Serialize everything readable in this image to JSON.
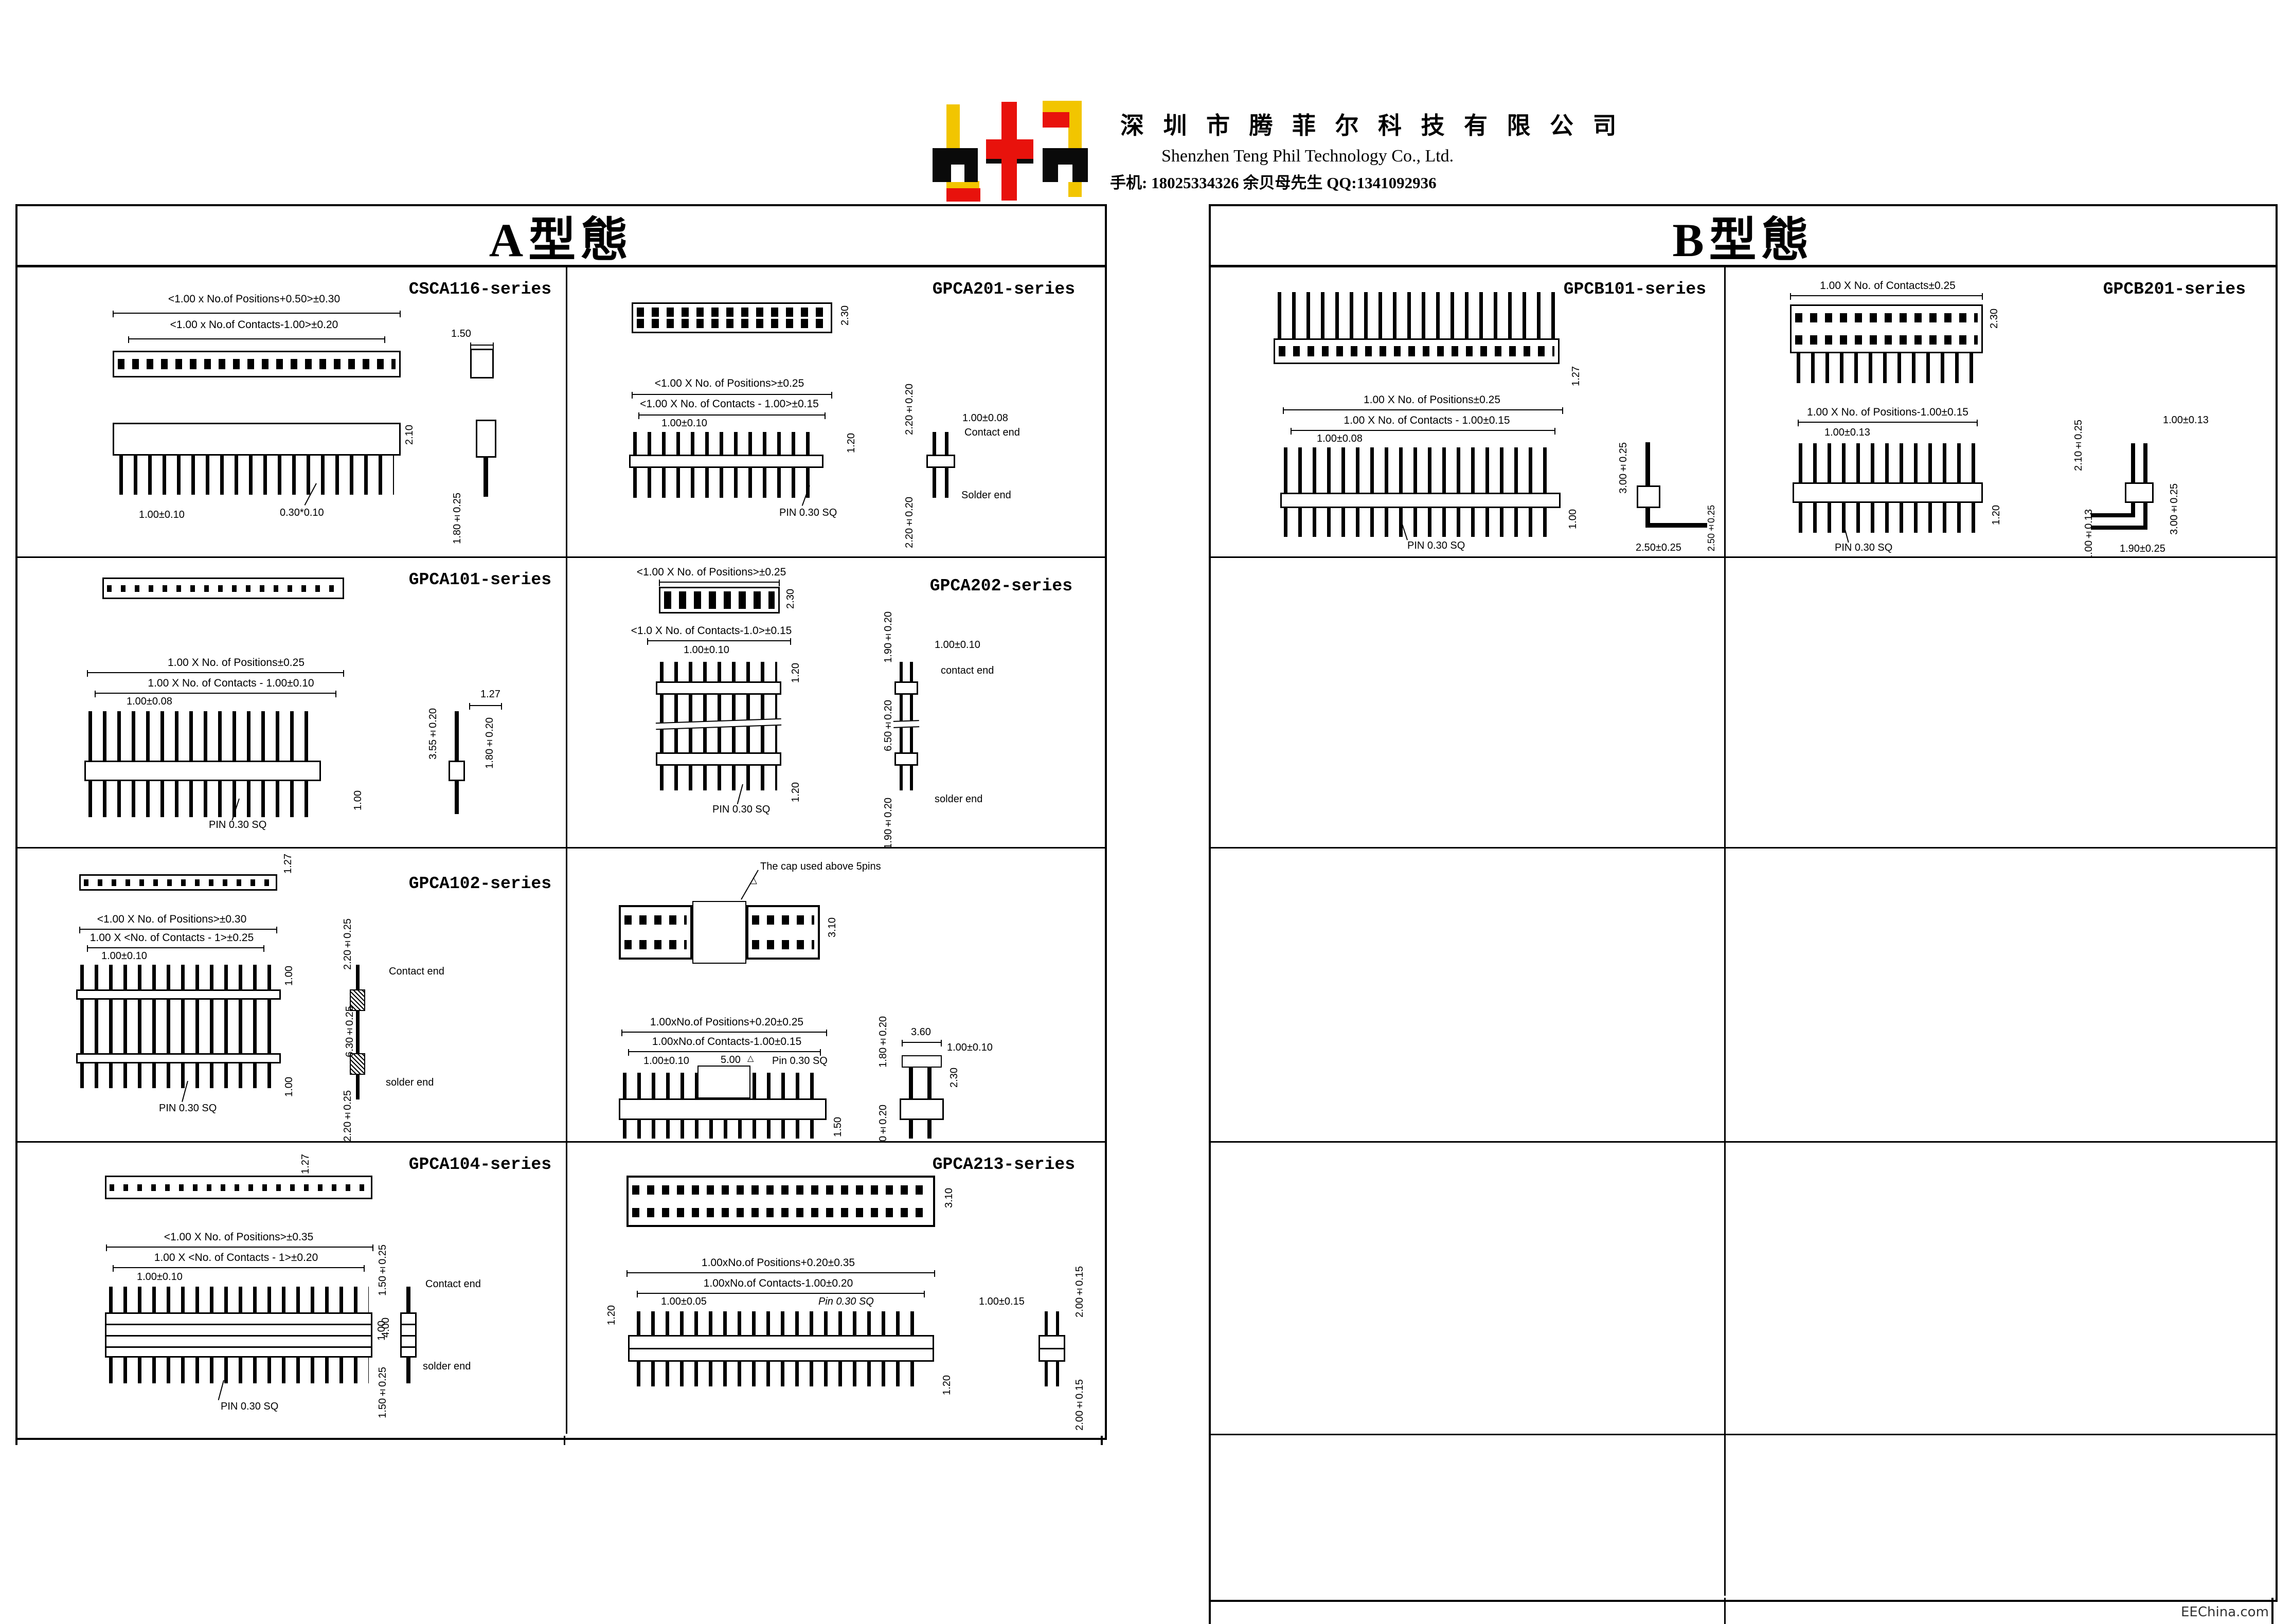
{
  "header": {
    "company_cn": "深 圳 市 腾 菲 尔 科 技 有 限 公 司",
    "company_en": "Shenzhen Teng Phil Technology Co., Ltd.",
    "contact": "手机: 18025334326 余贝母先生    QQ:1341092936"
  },
  "sections": {
    "a_title": "A型態",
    "b_title": "B型態"
  },
  "watermark": "EEChina.com",
  "cells": {
    "csca116": {
      "title": "CSCA116-series",
      "dim_positions": "<1.00 x No.of Positions+0.50>±0.30",
      "dim_contacts": "<1.00 x No.of Contacts-1.00>±0.20",
      "dim_150": "1.50",
      "dim_210": "2.10",
      "dim_pitch": "1.00±0.10",
      "dim_pin": "0.30*0.10",
      "dim_180": "1.80±0.25"
    },
    "gpca201": {
      "title": "GPCA201-series",
      "dim_230": "2.30",
      "dim_positions": "<1.00 X No. of Positions>±0.25",
      "dim_contacts": "<1.00 X No. of Contacts - 1.00>±0.15",
      "dim_pitch": "1.00±0.10",
      "dim_120": "1.20",
      "pin_note": "PIN 0.30 SQ",
      "dim_220_top": "2.20±0.20",
      "dim_100": "1.00±0.08",
      "contact_end": "Contact end",
      "solder_end": "Solder end",
      "dim_220_bot": "2.20±0.20"
    },
    "gpca101": {
      "title": "GPCA101-series",
      "dim_positions": "1.00 X No. of Positions±0.25",
      "dim_contacts": "1.00 X No. of Contacts - 1.00±0.10",
      "dim_pitch": "1.00±0.08",
      "pin_note": "PIN 0.30 SQ",
      "dim_100": "1.00",
      "dim_127": "1.27",
      "dim_355": "3.55±0.20",
      "dim_180": "1.80±0.20"
    },
    "gpca202": {
      "title": "GPCA202-series",
      "dim_positions": "<1.00 X No. of Positions>±0.25",
      "dim_230": "2.30",
      "dim_contacts": "<1.0 X No. of Contacts-1.0>±0.15",
      "dim_pitch": "1.00±0.10",
      "dim_120_top": "1.20",
      "dim_120_bot": "1.20",
      "pin_note": "PIN 0.30 SQ",
      "dim_190_top": "1.90±0.20",
      "dim_100": "1.00±0.10",
      "contact_end": "contact end",
      "dim_650": "6.50±0.20",
      "solder_end": "solder end",
      "dim_190_bot": "1.90±0.20"
    },
    "gpca102": {
      "title": "GPCA102-series",
      "dim_127": "1.27",
      "dim_positions": "<1.00 X No. of Positions>±0.30",
      "dim_contacts": "1.00 X <No. of Contacts - 1>±0.25",
      "dim_pitch": "1.00±0.10",
      "dim_100_top": "1.00",
      "dim_100_bot": "1.00",
      "pin_note": "PIN 0.30 SQ",
      "dim_220_top": "2.20±0.25",
      "contact_end": "Contact end",
      "dim_630": "6.30±0.25",
      "solder_end": "solder end",
      "dim_220_bot": "2.20±0.25"
    },
    "gpca210": {
      "title": "GPCA210-series",
      "cap_note": "The cap used above 5pins",
      "marker": "△",
      "dim_310": "3.10",
      "dim_positions": "1.00xNo.of Positions+0.20±0.25",
      "dim_contacts": "1.00xNo.of Contacts-1.00±0.15",
      "dim_pitch": "1.00±0.10",
      "dim_500": "5.00",
      "pin_note": "Pin 0.30 SQ",
      "dim_150": "1.50",
      "dim_180_top": "1.80±0.20",
      "dim_360": "3.60",
      "dim_100": "1.00±0.10",
      "dim_230": "2.30",
      "dim_180_bot": "1.80±0.20"
    },
    "gpca104": {
      "title": "GPCA104-series",
      "dim_127": "1.27",
      "dim_positions": "<1.00 X No. of Positions>±0.35",
      "dim_contacts": "1.00 X <No. of Contacts - 1>±0.20",
      "dim_pitch": "1.00±0.10",
      "dim_100": "1.00",
      "pin_note": "PIN 0.30 SQ",
      "dim_150_top": "1.50±0.25",
      "contact_end": "Contact end",
      "dim_400": "4.00",
      "solder_end": "solder end",
      "dim_150_bot": "1.50±0.25"
    },
    "gpca213": {
      "title": "GPCA213-series",
      "dim_310": "3.10",
      "dim_positions": "1.00xNo.of Positions+0.20±0.35",
      "dim_contacts": "1.00xNo.of Contacts-1.00±0.20",
      "dim_pitch": "1.00±0.05",
      "pin_note": "Pin 0.30 SQ",
      "dim_120_left": "1.20",
      "dim_120_bot": "1.20",
      "dim_100": "1.00±0.15",
      "dim_200_top": "2.00±0.15",
      "dim_200_bot": "2.00±0.15"
    },
    "gpcb101": {
      "title": "GPCB101-series",
      "dim_127": "1.27",
      "dim_positions": "1.00 X No. of Positions±0.25",
      "dim_contacts": "1.00 X No. of Contacts - 1.00±0.15",
      "dim_pitch": "1.00±0.08",
      "pin_note": "PIN 0.30 SQ",
      "dim_100": "1.00",
      "dim_300": "3.00±0.25",
      "dim_250_h": "2.50±0.25",
      "dim_250_v": "2.50±0.25"
    },
    "gpcb201": {
      "title": "GPCB201-series",
      "dim_contacts_top": "1.00 X No. of Contacts±0.25",
      "dim_230": "2.30",
      "dim_positions": "1.00 X No. of Positions-1.00±0.15",
      "dim_pitch": "1.00±0.13",
      "dim_120": "1.20",
      "pin_note": "PIN 0.30 SQ",
      "dim_100_top": "1.00±0.13",
      "dim_210": "2.10±0.25",
      "dim_300": "3.00±0.25",
      "dim_100_bot": "1.00±0.13",
      "dim_190": "1.90±0.25"
    }
  }
}
